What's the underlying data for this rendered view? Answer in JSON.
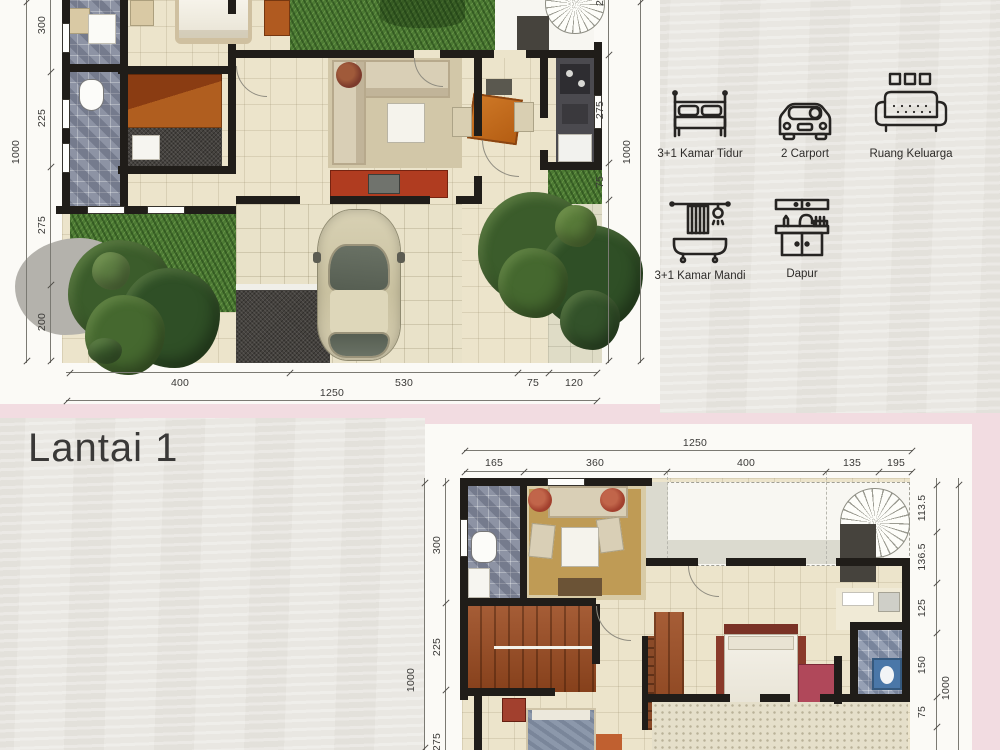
{
  "page": {
    "floor_label": "Lantai 1"
  },
  "legend": {
    "items": [
      {
        "icon": "bed-icon",
        "label": "3+1 Kamar Tidur"
      },
      {
        "icon": "car-icon",
        "label": "2 Carport"
      },
      {
        "icon": "sofa-icon",
        "label": "Ruang Keluarga"
      },
      {
        "icon": "bathtub-icon",
        "label": "3+1 Kamar Mandi"
      },
      {
        "icon": "kitchen-icon",
        "label": "Dapur"
      }
    ]
  },
  "plan1": {
    "dims": {
      "left_segments": [
        "300",
        "225",
        "275",
        "200"
      ],
      "left_total": "1000",
      "right_top_partial": "2",
      "right_segments": [
        "275",
        "75"
      ],
      "right_total": "1000",
      "bottom_segments": [
        "400",
        "530",
        "75",
        "120"
      ],
      "bottom_total": "1250"
    }
  },
  "plan2": {
    "dims": {
      "top_total": "1250",
      "top_segments": [
        "165",
        "360",
        "400",
        "135",
        "195"
      ],
      "left_segments": [
        "300",
        "225",
        "275"
      ],
      "left_total": "1000",
      "right_segments": [
        "113.5",
        "136.5",
        "125",
        "150",
        "75"
      ],
      "right_total": "1000"
    }
  },
  "colors": {
    "wall": "#201d19",
    "grass": "#4c7a33",
    "floor": "#ece4cb",
    "panel_pink": "#f2dce1",
    "wood": "#9c4b20",
    "carpet": "#bf9b55"
  }
}
